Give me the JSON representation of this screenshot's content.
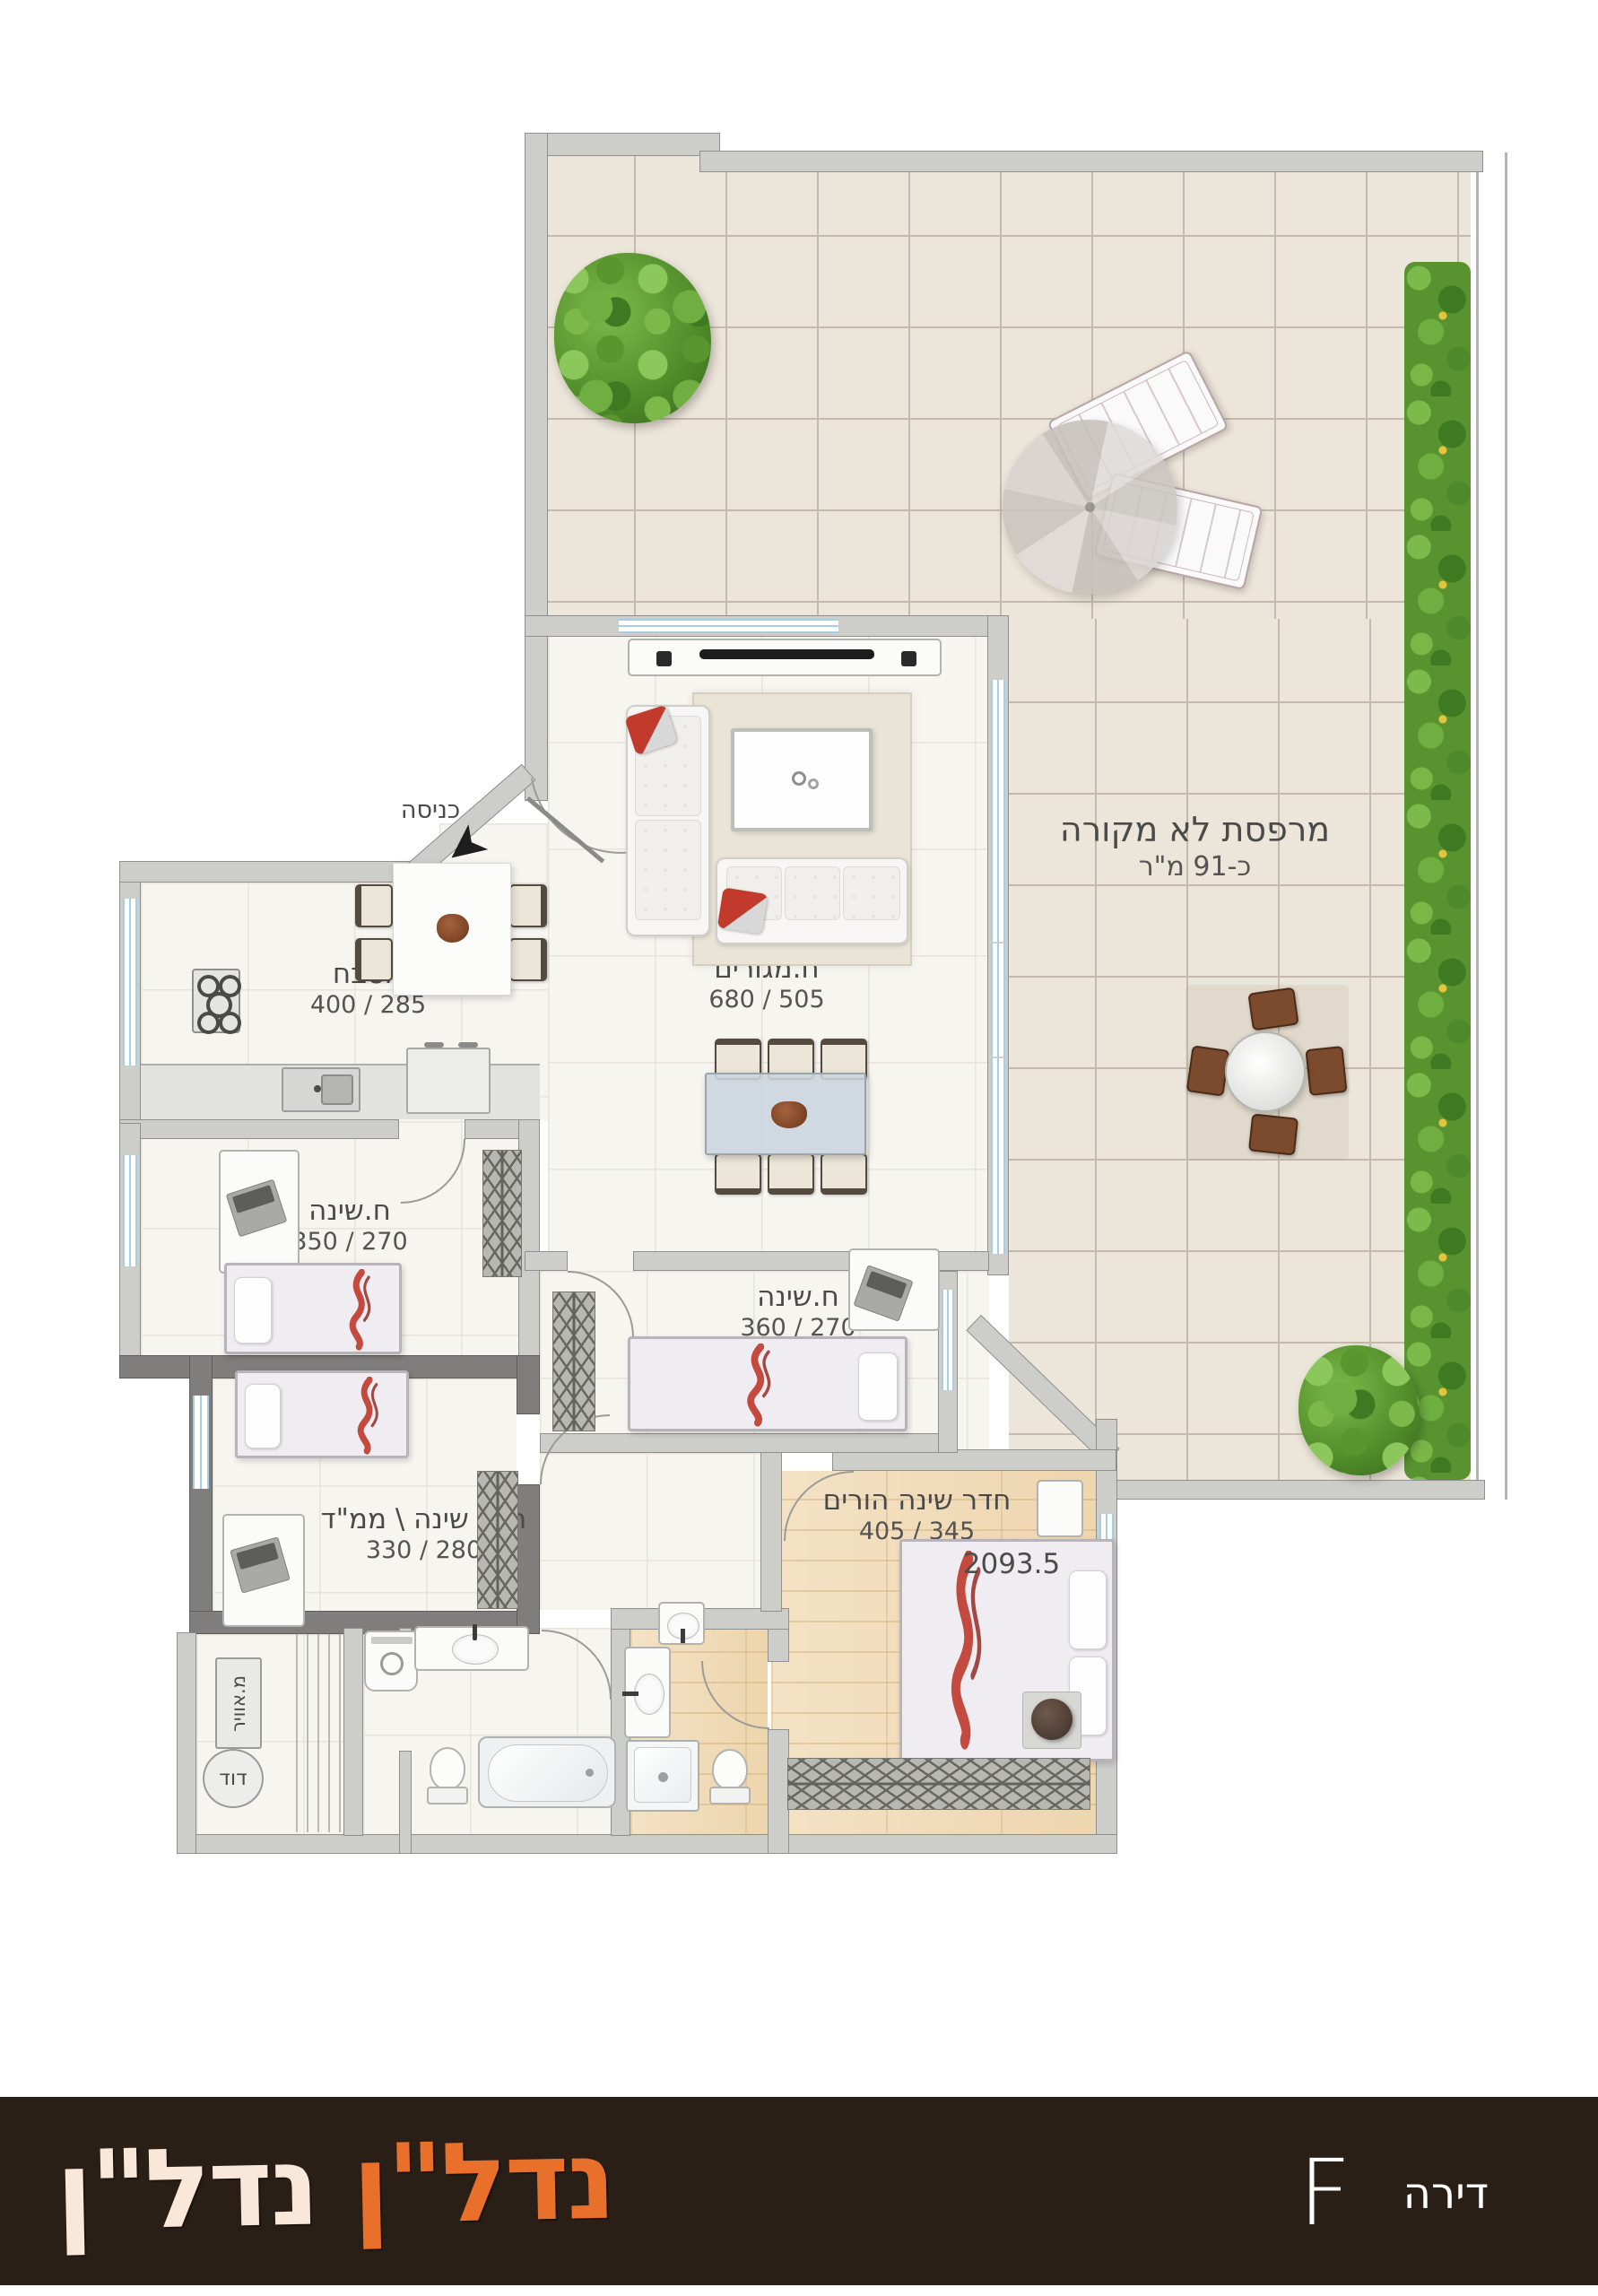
{
  "rooms": {
    "terrace": {
      "name": "מרפסת לא מקורה",
      "dims": "כ-91 מ\"ר"
    },
    "living": {
      "name": "ח.מגורים",
      "dims": "680 / 505"
    },
    "kitchen": {
      "name": "מטבח",
      "dims": "400 / 285"
    },
    "bedroom1": {
      "name": "ח.שינה",
      "dims": "350 / 270"
    },
    "bedroom3": {
      "name": "ח.שינה",
      "dims": "360 / 270"
    },
    "mamad": {
      "name": "חדר שינה \\ ממ\"ד",
      "dims": "330 / 280"
    },
    "master": {
      "name": "חדר שינה הורים",
      "dims": "405 / 345"
    }
  },
  "labels": {
    "entrance": "כניסה",
    "air_shaft": "מ.אוויר",
    "boiler": "דוד",
    "bed_tag": "2093.5"
  },
  "footer": {
    "brand_first": "נדל\"ן",
    "brand_second": "נדל\"ן",
    "unit_word": "דירה",
    "unit_letter": "F"
  },
  "colors": {
    "brand_orange": "#e8702a",
    "brand_cream": "#f9e8da",
    "bar_bg": "#2a1f17",
    "window_blue": "#a6cfe2",
    "red_accent": "#bf372a"
  }
}
